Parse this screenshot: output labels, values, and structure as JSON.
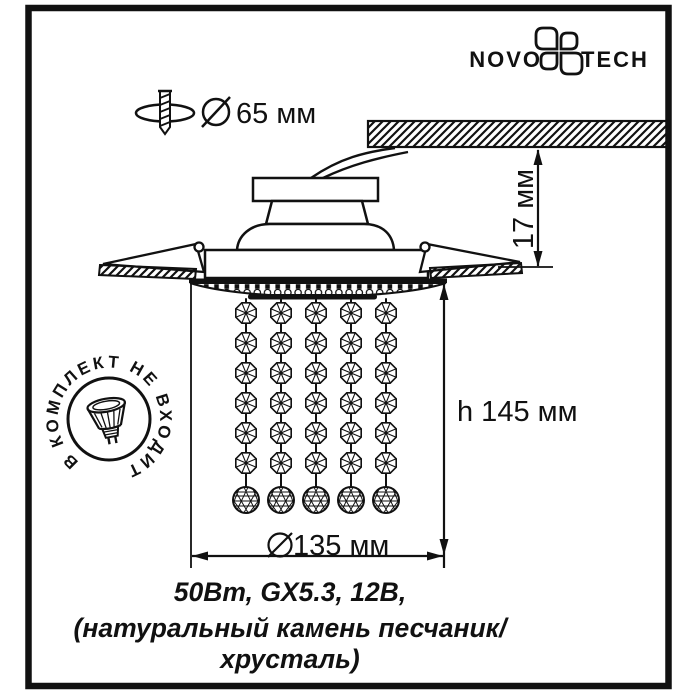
{
  "colors": {
    "ink": "#111111",
    "paper": "#ffffff"
  },
  "brand": {
    "left": "NOVO",
    "right": "TECH"
  },
  "icons": {
    "brand": "novotech-flower-icon",
    "cutout": "screw-through-hole-icon",
    "diameter_symbol": "diameter-slash-circle-icon",
    "stamp": "mr16-lamp-icon"
  },
  "cutout": {
    "diameter": "65 мм"
  },
  "dimensions": {
    "protrusion": "17 мм",
    "height": "h 145 мм",
    "diameter": "135 мм"
  },
  "stamp": {
    "arc_text": "В КОМПЛЕКТ НЕ ВХОДИТ"
  },
  "caption": {
    "line1": "50Вт, GX5.3, 12В,",
    "line2": "(натуральный камень песчаник/",
    "line3": "хрусталь)"
  }
}
